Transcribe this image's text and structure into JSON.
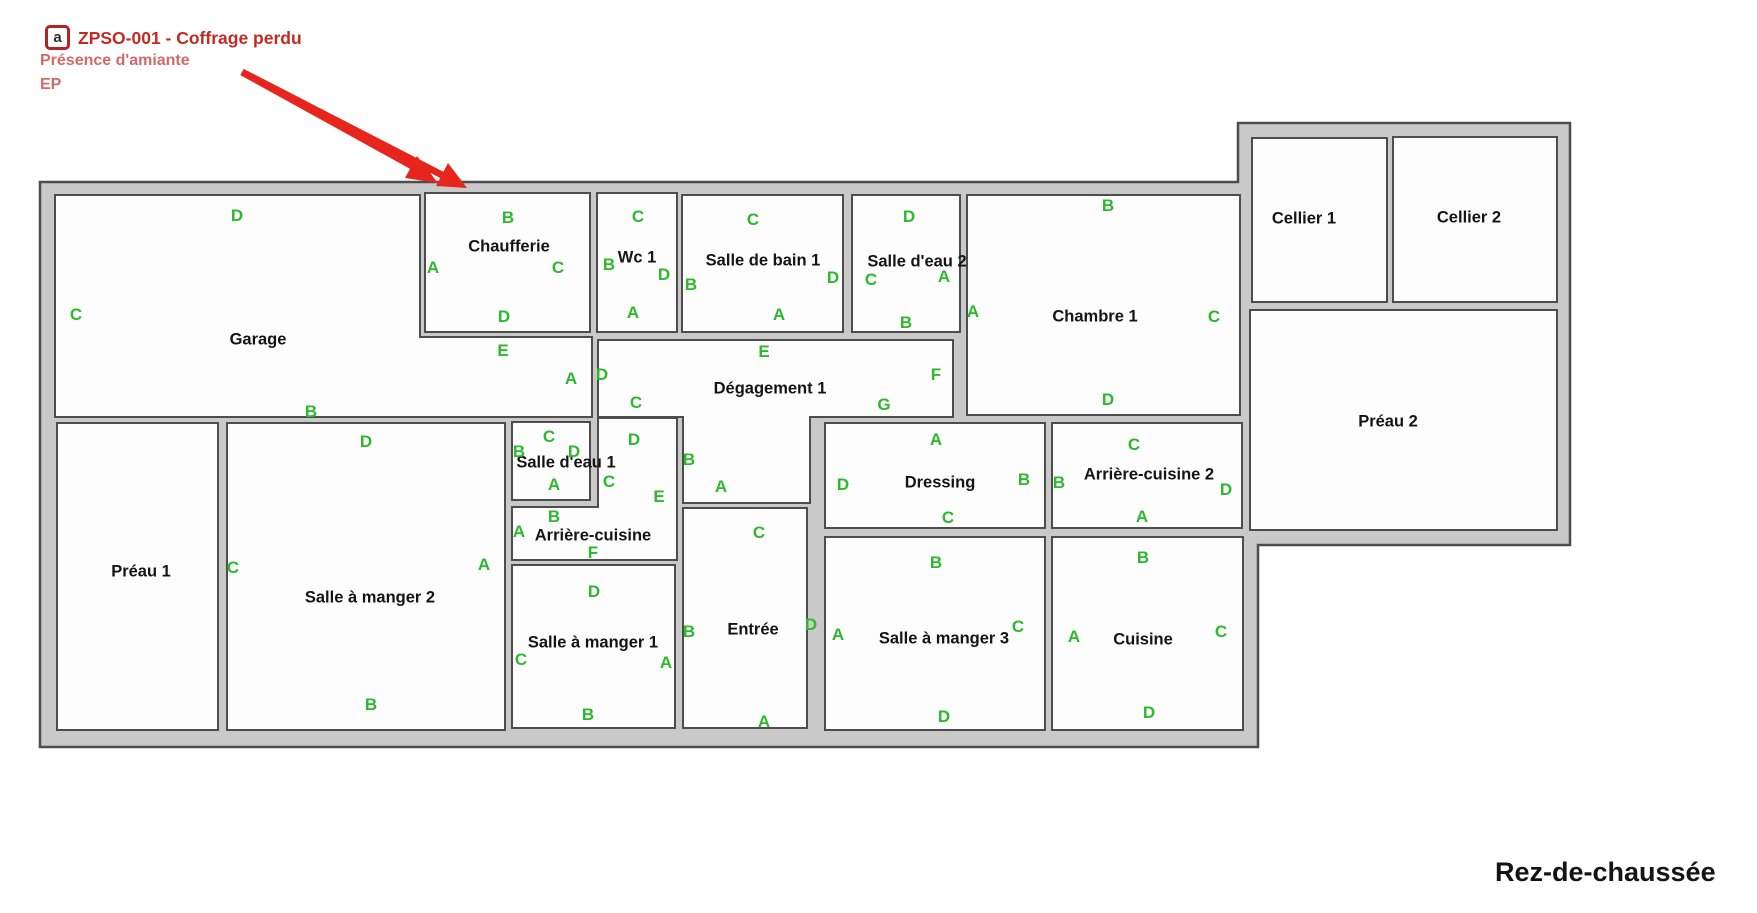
{
  "floor_label": "Rez-de-chaussée",
  "annotation": {
    "icon_glyph": "a",
    "title": "ZPSO-001 - Coffrage perdu",
    "line2": "Présence d'amiante",
    "line3": "EP"
  },
  "colors": {
    "wall_fill": "#c9c9c9",
    "wall_stroke": "#4d4d4d",
    "room_fill": "#fdfdfd",
    "letter_green": "#2db92d",
    "label_black": "#141414",
    "annotation_title_red": "#c22a22",
    "annotation_sub_red": "#d36a6a",
    "arrow_red": "#e8251d",
    "icon_border_red": "#b32424",
    "background": "#ffffff"
  },
  "rooms": [
    {
      "id": "garage",
      "label": "Garage",
      "lx": 258,
      "ly": 340,
      "letters": [
        {
          "t": "D",
          "x": 237,
          "y": 216
        },
        {
          "t": "C",
          "x": 76,
          "y": 315
        },
        {
          "t": "B",
          "x": 311,
          "y": 412
        },
        {
          "t": "E",
          "x": 503,
          "y": 351
        },
        {
          "t": "A",
          "x": 571,
          "y": 379
        }
      ]
    },
    {
      "id": "chaufferie",
      "label": "Chaufferie",
      "lx": 509,
      "ly": 247,
      "letters": [
        {
          "t": "B",
          "x": 508,
          "y": 218
        },
        {
          "t": "A",
          "x": 433,
          "y": 268
        },
        {
          "t": "C",
          "x": 558,
          "y": 268
        },
        {
          "t": "D",
          "x": 504,
          "y": 317
        }
      ]
    },
    {
      "id": "wc-1",
      "label": "Wc 1",
      "lx": 637,
      "ly": 258,
      "letters": [
        {
          "t": "C",
          "x": 638,
          "y": 217
        },
        {
          "t": "B",
          "x": 609,
          "y": 265
        },
        {
          "t": "D",
          "x": 664,
          "y": 275
        },
        {
          "t": "A",
          "x": 633,
          "y": 313
        }
      ]
    },
    {
      "id": "salle-de-bain-1",
      "label": "Salle de bain 1",
      "lx": 763,
      "ly": 261,
      "letters": [
        {
          "t": "C",
          "x": 753,
          "y": 220
        },
        {
          "t": "B",
          "x": 691,
          "y": 285
        },
        {
          "t": "D",
          "x": 833,
          "y": 278
        },
        {
          "t": "A",
          "x": 779,
          "y": 315
        }
      ]
    },
    {
      "id": "salle-d-eau-2",
      "label": "Salle d'eau 2",
      "lx": 917,
      "ly": 262,
      "letters": [
        {
          "t": "D",
          "x": 909,
          "y": 217
        },
        {
          "t": "C",
          "x": 871,
          "y": 280
        },
        {
          "t": "A",
          "x": 944,
          "y": 277
        },
        {
          "t": "B",
          "x": 906,
          "y": 323
        }
      ]
    },
    {
      "id": "chambre-1",
      "label": "Chambre 1",
      "lx": 1095,
      "ly": 317,
      "letters": [
        {
          "t": "B",
          "x": 1108,
          "y": 206
        },
        {
          "t": "A",
          "x": 973,
          "y": 312
        },
        {
          "t": "C",
          "x": 1214,
          "y": 317
        },
        {
          "t": "D",
          "x": 1108,
          "y": 400
        }
      ]
    },
    {
      "id": "degagement-1",
      "label": "Dégagement 1",
      "lx": 770,
      "ly": 389,
      "letters": [
        {
          "t": "E",
          "x": 764,
          "y": 352
        },
        {
          "t": "D",
          "x": 602,
          "y": 375
        },
        {
          "t": "F",
          "x": 936,
          "y": 375
        },
        {
          "t": "G",
          "x": 884,
          "y": 405
        },
        {
          "t": "C",
          "x": 636,
          "y": 403
        },
        {
          "t": "B",
          "x": 689,
          "y": 460
        },
        {
          "t": "A",
          "x": 721,
          "y": 487
        }
      ]
    },
    {
      "id": "salle-d-eau-1",
      "label": "Salle d'eau 1",
      "lx": 566,
      "ly": 463,
      "letters": [
        {
          "t": "C",
          "x": 549,
          "y": 437
        },
        {
          "t": "B",
          "x": 519,
          "y": 452
        },
        {
          "t": "D",
          "x": 574,
          "y": 452
        },
        {
          "t": "A",
          "x": 554,
          "y": 485
        }
      ]
    },
    {
      "id": "arriere-cuisine",
      "label": "Arrière-cuisine",
      "lx": 593,
      "ly": 536,
      "letters": [
        {
          "t": "D",
          "x": 634,
          "y": 440
        },
        {
          "t": "C",
          "x": 609,
          "y": 482
        },
        {
          "t": "E",
          "x": 659,
          "y": 497
        },
        {
          "t": "B",
          "x": 554,
          "y": 517
        },
        {
          "t": "A",
          "x": 519,
          "y": 532
        },
        {
          "t": "F",
          "x": 593,
          "y": 553
        }
      ]
    },
    {
      "id": "preau-1",
      "label": "Préau 1",
      "lx": 141,
      "ly": 572,
      "letters": []
    },
    {
      "id": "salle-a-manger-2",
      "label": "Salle à manger 2",
      "lx": 370,
      "ly": 598,
      "letters": [
        {
          "t": "D",
          "x": 366,
          "y": 442
        },
        {
          "t": "C",
          "x": 233,
          "y": 568
        },
        {
          "t": "A",
          "x": 484,
          "y": 565
        },
        {
          "t": "B",
          "x": 371,
          "y": 705
        }
      ]
    },
    {
      "id": "salle-a-manger-1",
      "label": "Salle à manger 1",
      "lx": 593,
      "ly": 643,
      "letters": [
        {
          "t": "D",
          "x": 594,
          "y": 592
        },
        {
          "t": "C",
          "x": 521,
          "y": 660
        },
        {
          "t": "A",
          "x": 666,
          "y": 663
        },
        {
          "t": "B",
          "x": 588,
          "y": 715
        }
      ]
    },
    {
      "id": "entree",
      "label": "Entrée",
      "lx": 753,
      "ly": 630,
      "letters": [
        {
          "t": "C",
          "x": 759,
          "y": 533
        },
        {
          "t": "B",
          "x": 689,
          "y": 632
        },
        {
          "t": "D",
          "x": 811,
          "y": 625
        },
        {
          "t": "A",
          "x": 764,
          "y": 722
        }
      ]
    },
    {
      "id": "dressing",
      "label": "Dressing",
      "lx": 940,
      "ly": 483,
      "letters": [
        {
          "t": "A",
          "x": 936,
          "y": 440
        },
        {
          "t": "D",
          "x": 843,
          "y": 485
        },
        {
          "t": "B",
          "x": 1024,
          "y": 480
        },
        {
          "t": "C",
          "x": 948,
          "y": 518
        }
      ]
    },
    {
      "id": "arriere-cuisine-2",
      "label": "Arrière-cuisine 2",
      "lx": 1149,
      "ly": 475,
      "letters": [
        {
          "t": "C",
          "x": 1134,
          "y": 445
        },
        {
          "t": "B",
          "x": 1059,
          "y": 483
        },
        {
          "t": "D",
          "x": 1226,
          "y": 490
        },
        {
          "t": "A",
          "x": 1142,
          "y": 517
        }
      ]
    },
    {
      "id": "salle-a-manger-3",
      "label": "Salle à manger 3",
      "lx": 944,
      "ly": 639,
      "letters": [
        {
          "t": "B",
          "x": 936,
          "y": 563
        },
        {
          "t": "A",
          "x": 838,
          "y": 635
        },
        {
          "t": "C",
          "x": 1018,
          "y": 627
        },
        {
          "t": "D",
          "x": 944,
          "y": 717
        }
      ]
    },
    {
      "id": "cuisine",
      "label": "Cuisine",
      "lx": 1143,
      "ly": 640,
      "letters": [
        {
          "t": "B",
          "x": 1143,
          "y": 558
        },
        {
          "t": "A",
          "x": 1074,
          "y": 637
        },
        {
          "t": "C",
          "x": 1221,
          "y": 632
        },
        {
          "t": "D",
          "x": 1149,
          "y": 713
        }
      ]
    },
    {
      "id": "cellier-1",
      "label": "Cellier 1",
      "lx": 1304,
      "ly": 219,
      "letters": []
    },
    {
      "id": "cellier-2",
      "label": "Cellier 2",
      "lx": 1469,
      "ly": 218,
      "letters": []
    },
    {
      "id": "preau-2",
      "label": "Préau 2",
      "lx": 1388,
      "ly": 422,
      "letters": []
    }
  ]
}
